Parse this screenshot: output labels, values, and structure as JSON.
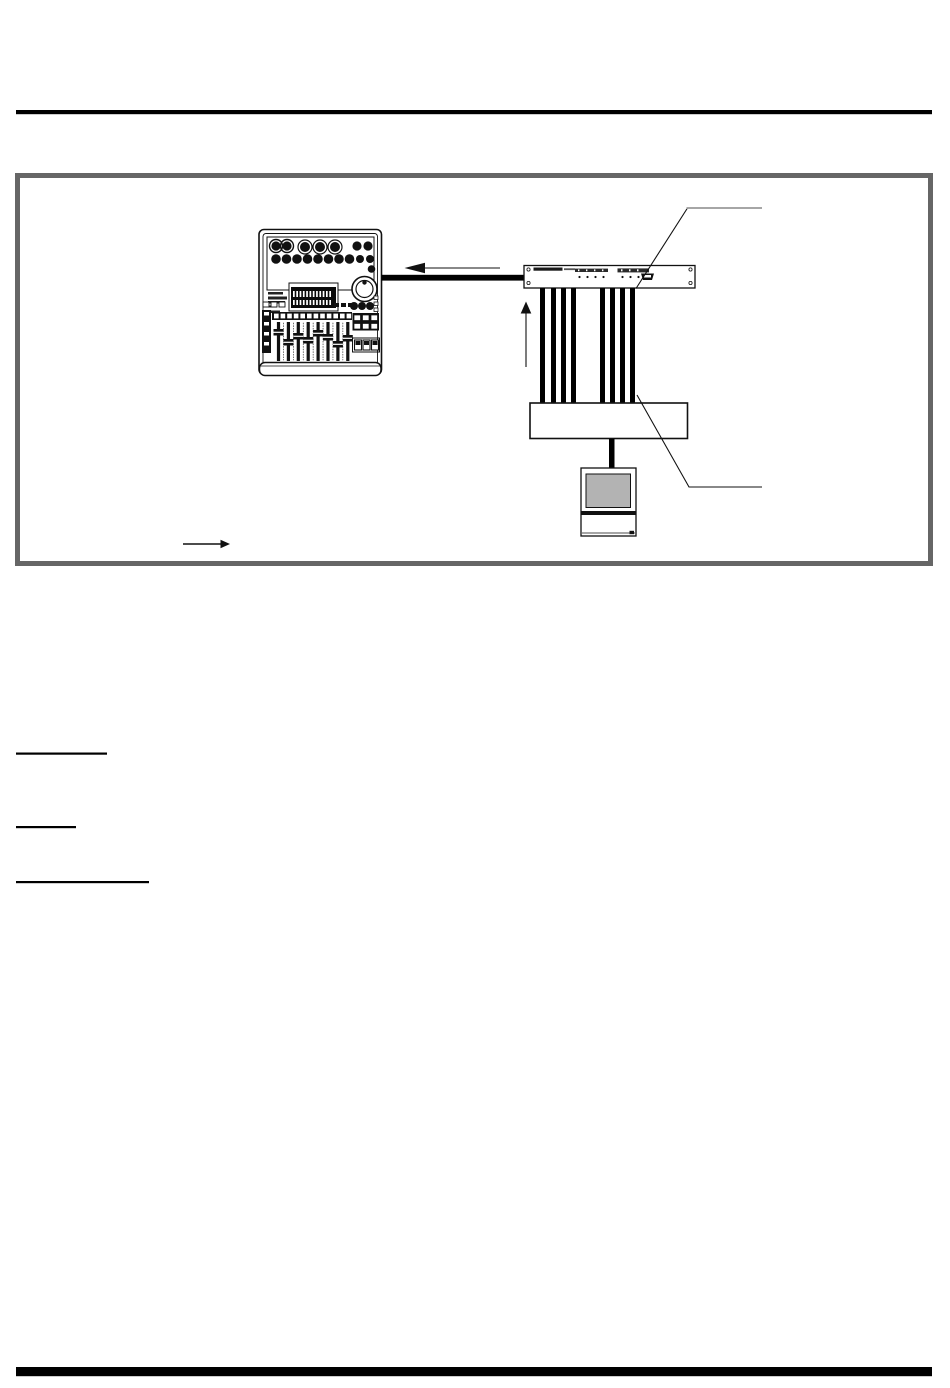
{
  "document": {
    "kind": "printed-manual-page-with-connection-diagram",
    "visible_text": ""
  },
  "colors": {
    "page_bg": "#ffffff",
    "rule": "#000000",
    "ink": "#111111",
    "frame": "#666666",
    "monitor_screen": "#b3b3b3",
    "callout_gray": "#9a9a9a",
    "cable": "#000000"
  },
  "figure": {
    "devices": [
      {
        "id": "digital-mixer"
      },
      {
        "id": "rack-interface-unit"
      },
      {
        "id": "breakout-box"
      },
      {
        "id": "computer-monitor"
      }
    ],
    "cables": {
      "count": 8,
      "x": [
        540,
        551,
        561,
        571,
        600,
        610,
        620,
        630
      ],
      "width": 5,
      "top": 288,
      "bottom": 403
    },
    "callouts": [
      {
        "from": [
          636,
          288.5
        ],
        "elbow": [
          687.5,
          208
        ],
        "end": [
          762,
          208
        ]
      },
      {
        "from": [
          637,
          395
        ],
        "elbow": [
          689,
          487
        ],
        "end": [
          762,
          487
        ]
      }
    ]
  },
  "underlines": [
    {
      "x": 16,
      "y": 752.5,
      "w": 91,
      "h": 2.2
    },
    {
      "x": 16,
      "y": 826,
      "w": 60,
      "h": 2.2
    },
    {
      "x": 16,
      "y": 881,
      "w": 133,
      "h": 2.2
    }
  ],
  "rules": {
    "top": {
      "x": 16,
      "y": 110,
      "w": 916,
      "h": 4.2
    },
    "bottom": {
      "x": 16,
      "y": 1367,
      "w": 916,
      "h": 9.2
    }
  }
}
